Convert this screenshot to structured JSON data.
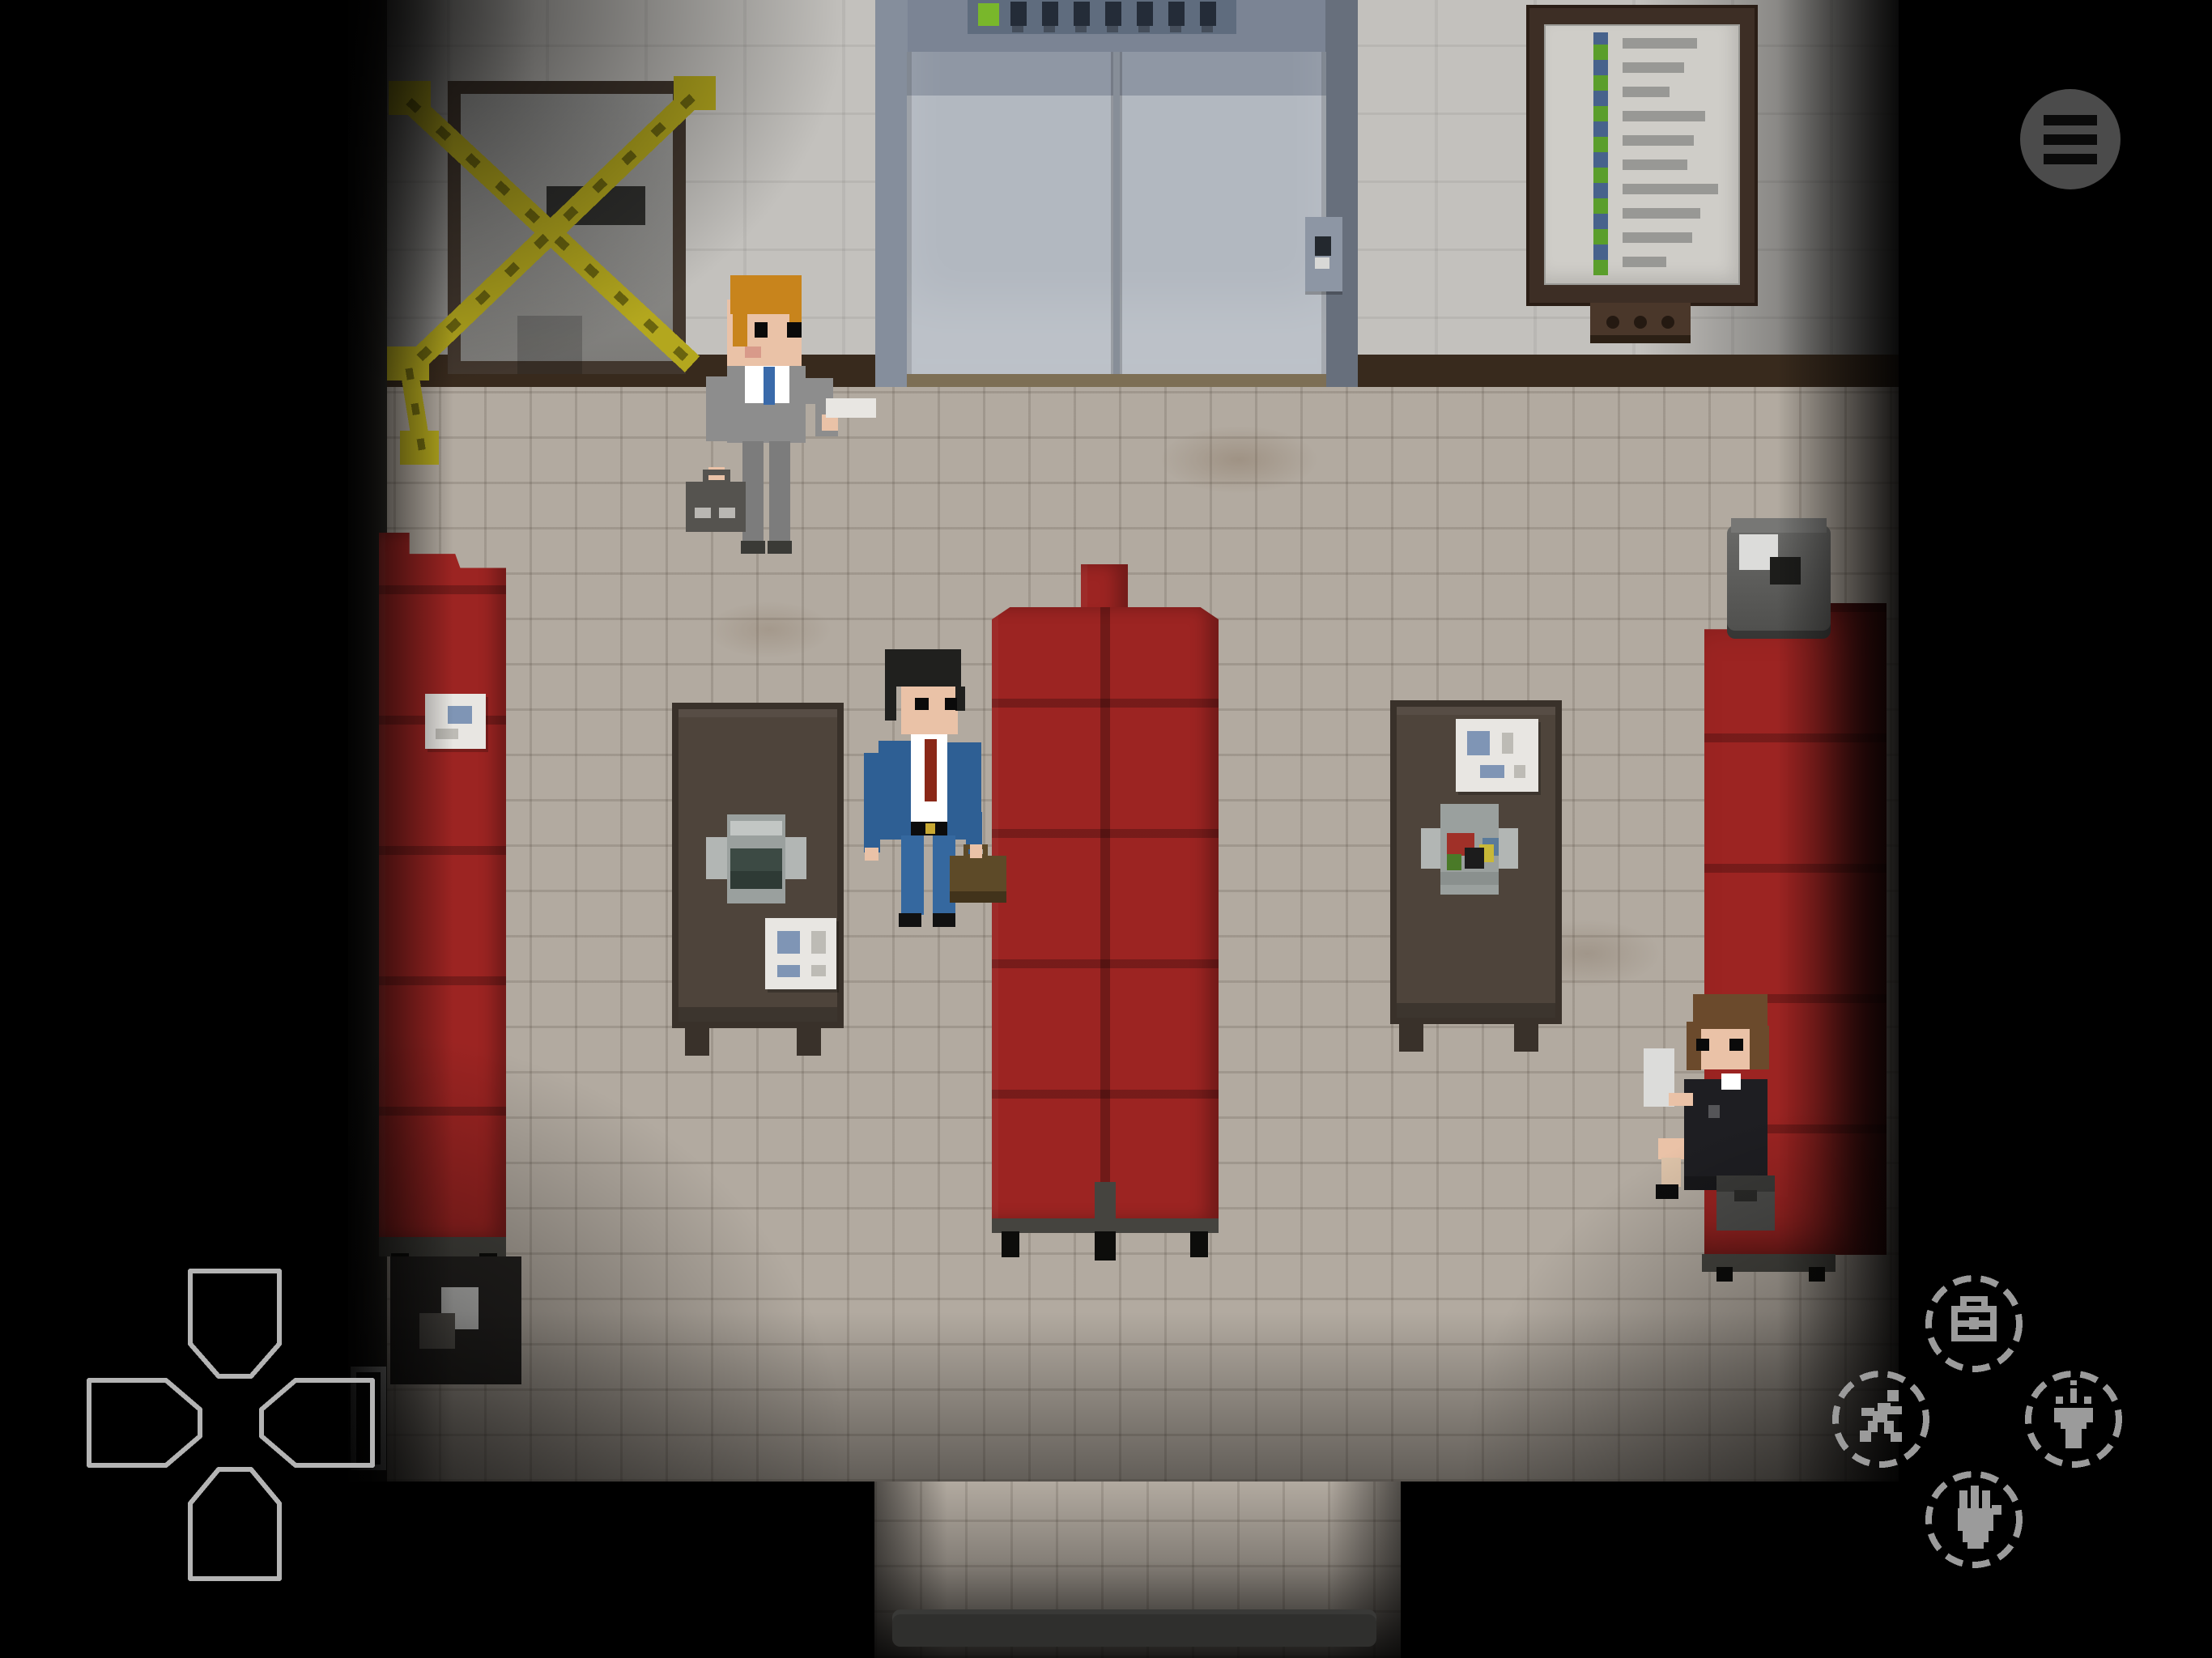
{
  "meta": {
    "app": "pixel-art adventure game",
    "scene": "office lobby with elevator, red waiting benches and safes, viewed top-down"
  },
  "palette": {
    "bg": "#000000",
    "wall": "#c3c1bd",
    "baseboard": "#382a1d",
    "floor": "#b2aaa0",
    "bench_red": "#9c2422",
    "bench_base": "#45443f",
    "safe_body": "#4e443b",
    "safe_edge": "#39312a",
    "dial_gray": "#b2b6b4",
    "dial_inner": "#3c4a44",
    "elevator_frame": "#7b8494",
    "elevator_door": "#b2b8c0",
    "elevator_sill": "#7d6f55",
    "indicator": "#5f6c7e",
    "indicator_slot": "#242c38",
    "indicator_green": "#79b72b",
    "door_frame": "#42372e",
    "door_gray": "#969695",
    "tape_yellow": "#b3a71e",
    "tape_dark": "#6a640f",
    "board_frame": "#3d2e25",
    "board_paper": "#cfcdc8",
    "board_green": "#5a9e2b",
    "board_blue": "#47628c",
    "board_text": "#989895",
    "skin": "#eac2a7",
    "hair_blonde": "#c8841c",
    "hair_black": "#20201e",
    "hair_brown": "#6b4a2c",
    "suit_gray": "#8d8d8d",
    "suit_gray_dark": "#7c7c7c",
    "suit_blue": "#2e5f94",
    "pants_blue": "#35689f",
    "suit_black": "#1e1e22",
    "shirt": "#ffffff",
    "tie_blue": "#3a6aaa",
    "tie_red": "#8a2818",
    "belt_gold": "#c8a832",
    "case_dark": "#55534f",
    "case_brown": "#5d4a28",
    "paper": "#e8e6e2",
    "paper_blue": "#7f95b5",
    "trash_gray": "#5f5f5d",
    "trash_dark": "#242220",
    "ui_gray": "#9b9b9b",
    "ui_circle": "#4b4b4b",
    "ui_outline": "#b4b4b4"
  },
  "hud": {
    "menu_button": {
      "label": "menu",
      "icon": "hamburger-menu-icon"
    },
    "dpad": {
      "up": "move up",
      "down": "move down",
      "left": "move left",
      "right": "move right"
    },
    "action_buttons": {
      "inventory": {
        "label": "inventory",
        "icon": "briefcase-icon"
      },
      "run": {
        "label": "run",
        "icon": "running-person-icon"
      },
      "flashlight": {
        "label": "flashlight",
        "icon": "flashlight-icon"
      },
      "interact": {
        "label": "interact",
        "icon": "hand-icon"
      }
    }
  },
  "scene": {
    "objects": {
      "elevator": "elevator with closed doors, green indicator light and call panel",
      "taped_door": "door sealed with yellow caution tape X",
      "notice_board": "wall directory board with green strip and illegible listing",
      "bench_left": "red upholstered bench along left wall with pinned note",
      "bench_center": "double-sided red upholstered bench",
      "bench_right": "red upholstered bench along right wall",
      "safe_left": "metal safe with gray combination dial and taped note",
      "safe_right": "metal safe with colored dial and taped note",
      "trash_can_top": "metal trash can with crumpled paper",
      "trash_can_bottom": "dark trash can in dim corner",
      "floor_mat": "dark mat in exit corridor",
      "vent": "small white framed vent on lower left wall"
    },
    "characters": {
      "blonde_man": "blonde man in gray suit holding briefcase and paper",
      "dark_haired_man": "dark-haired man in blue suit with red tie and brown briefcase",
      "woman": "brown-haired woman in dark suit sitting on bench reading a paper, bag beside her"
    }
  }
}
